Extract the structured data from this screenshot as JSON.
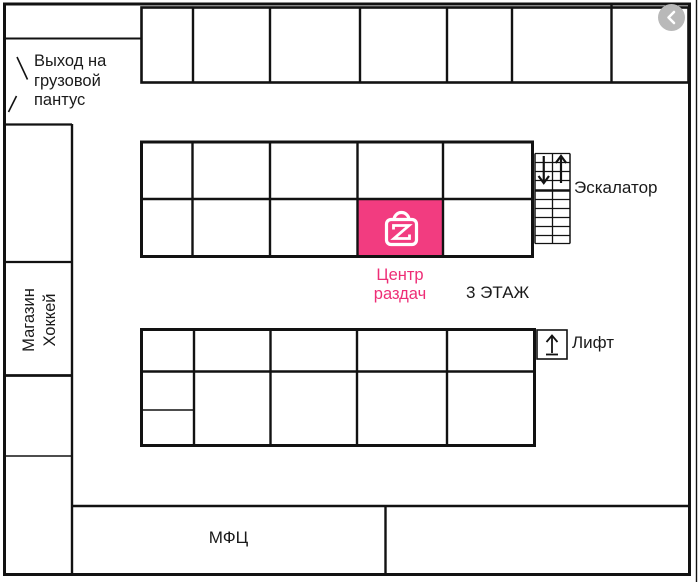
{
  "header": {
    "back_button": {
      "icon": "chevron-left-icon"
    }
  },
  "floor_plan": {
    "floor_label": "3 ЭТАЖ",
    "pickup_point": {
      "name": "Центр раздач",
      "icon": "shopping-bag-z-icon"
    },
    "rooms": {
      "exit_label": "Выход на грузовой пантус",
      "store_label": "Магазин Хоккей",
      "mfc_label": "МФЦ"
    },
    "transport": {
      "escalator_label": "Эскалатор",
      "escalator_icons": [
        "down-arrow-icon",
        "up-arrow-icon"
      ],
      "lift_label": "Лифт",
      "lift_icon": "up-arrow-from-bar-icon"
    }
  },
  "colors": {
    "accent_pink": "#f23c80",
    "label_pink": "#ee2d76",
    "wall_black": "#121212",
    "button_gray": "#b9b9b9"
  }
}
